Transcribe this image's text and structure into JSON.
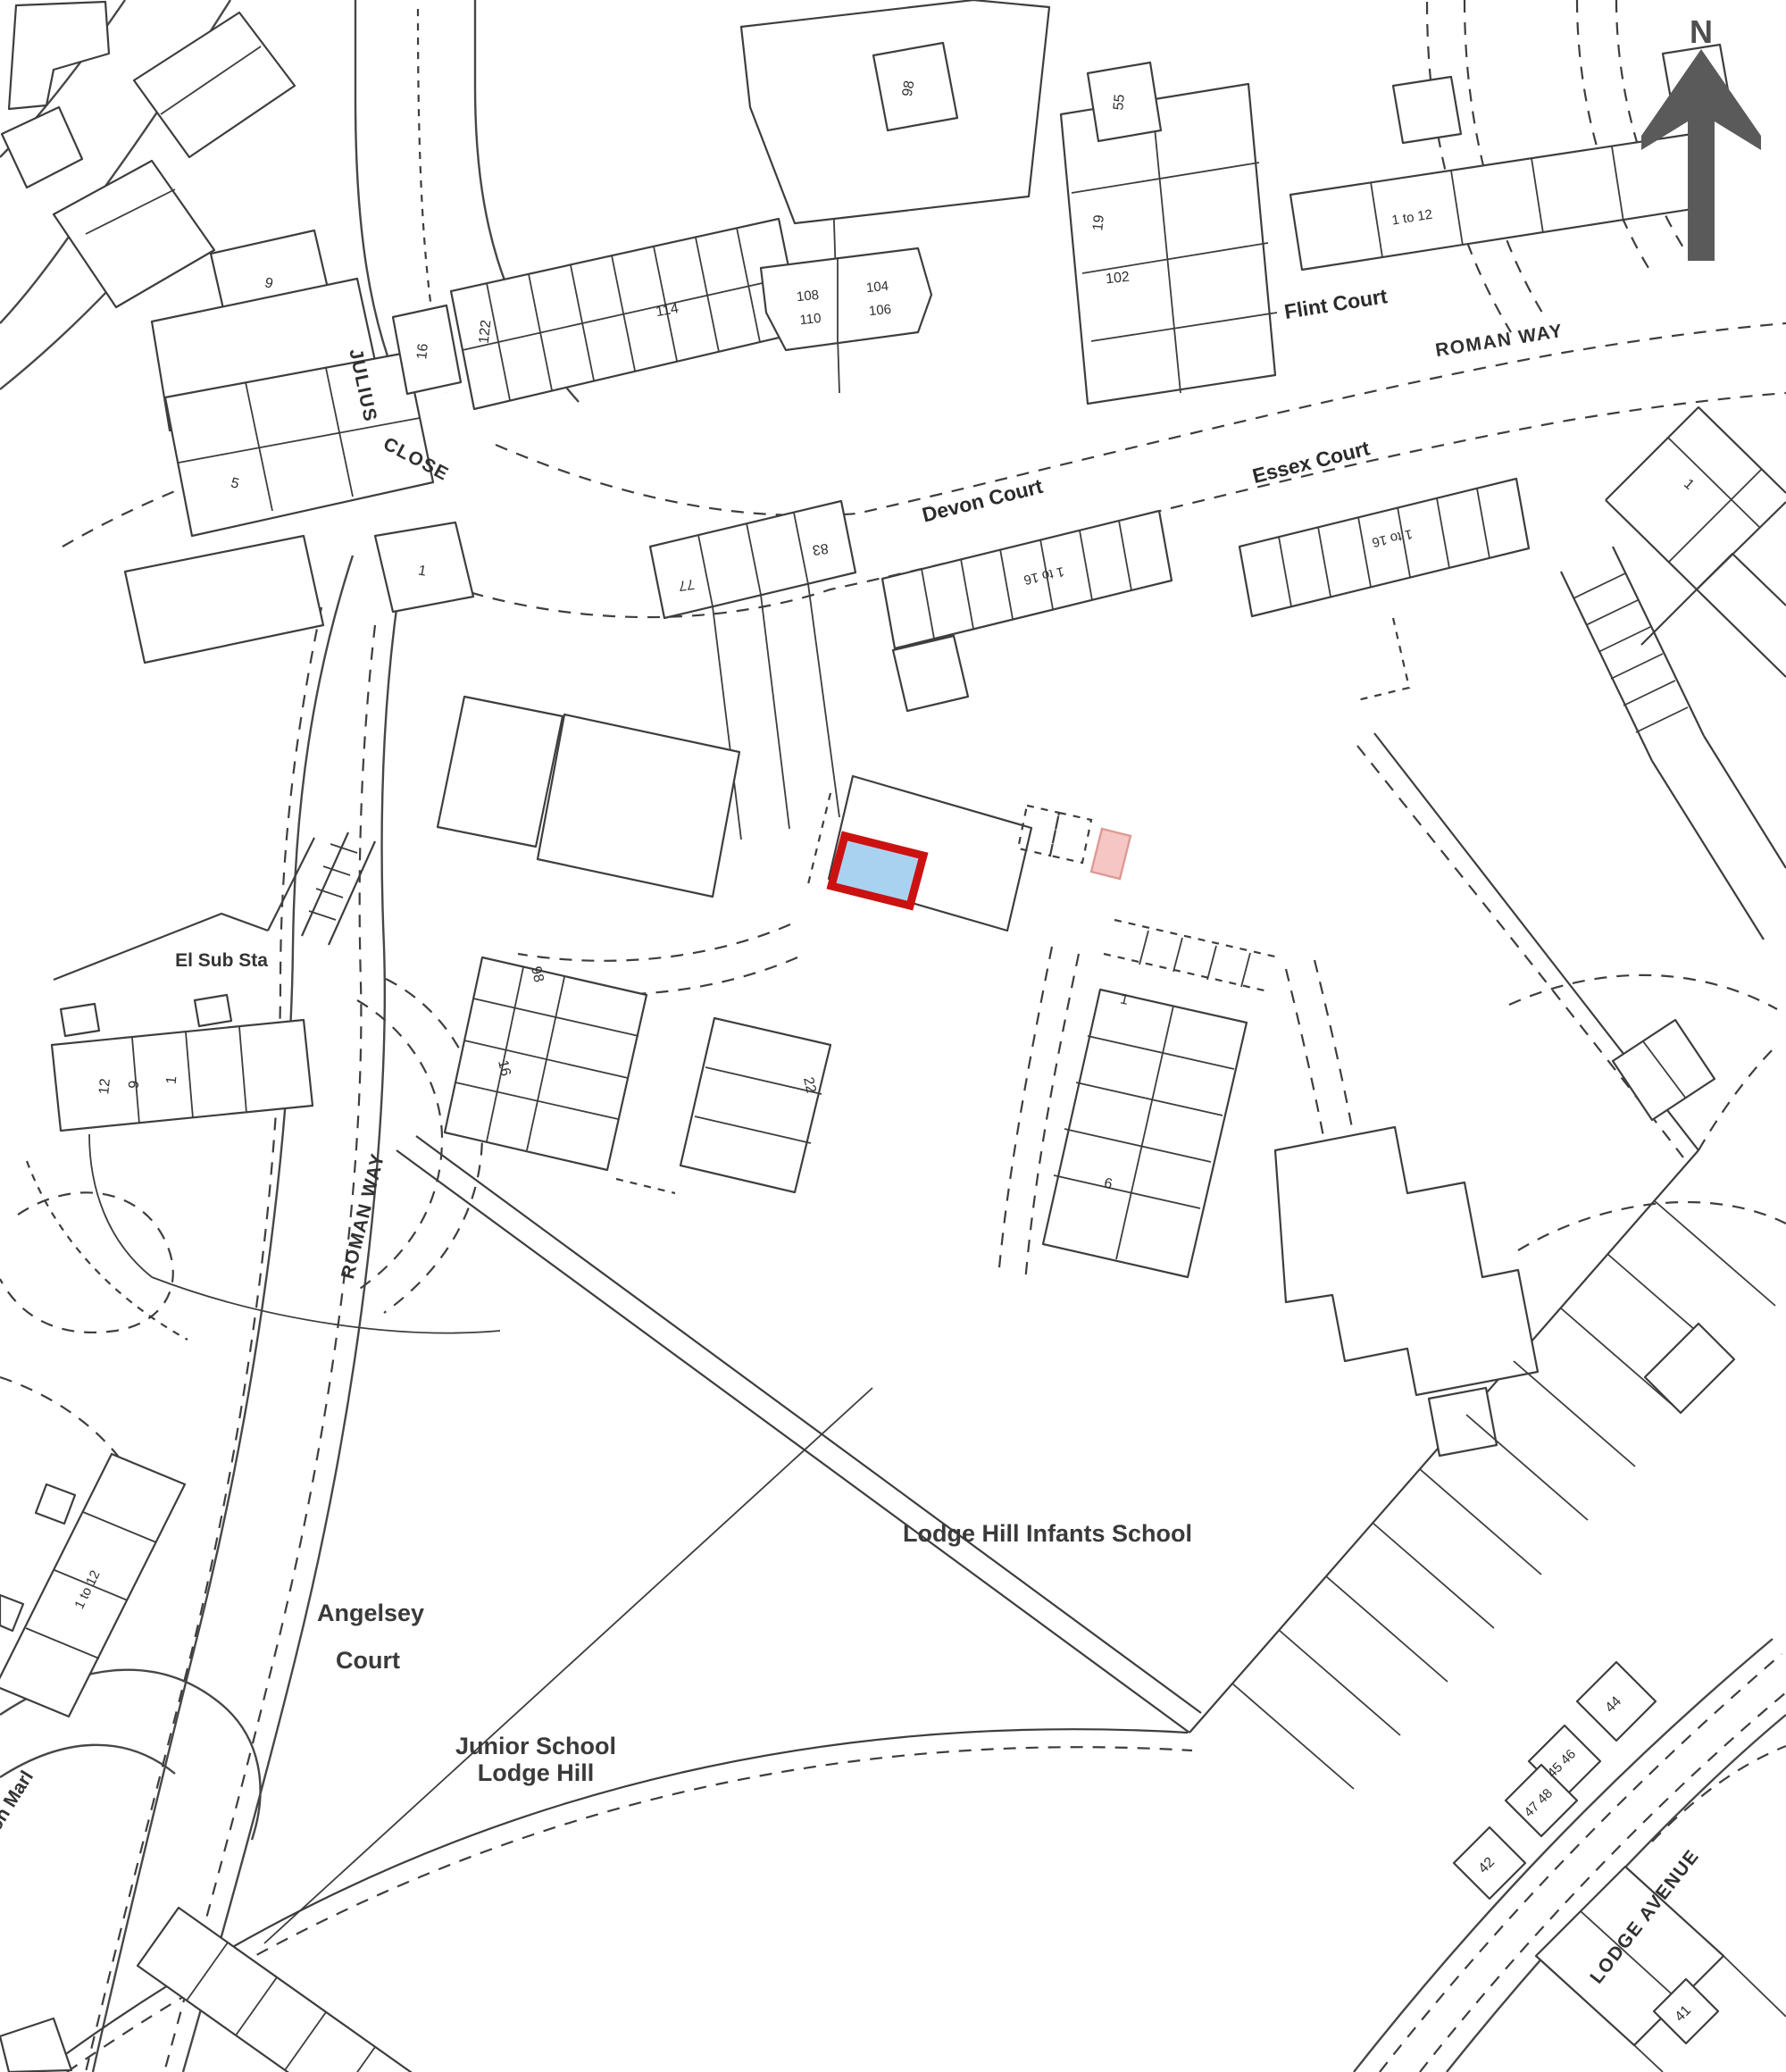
{
  "map": {
    "title": "Site location plan",
    "highlight_fill": "#a9d2f0",
    "highlight_stroke": "#cc1111",
    "secondary_fill": "#f5c6c4",
    "north_arrow_color": "#5a5a5a",
    "line_color": "#3e3e3e"
  },
  "labels": {
    "north": "N",
    "julius": "JULIUS",
    "close": "CLOSE",
    "roman_way_top": "ROMAN WAY",
    "roman_way_left": "ROMAN WAY",
    "flint_court": "Flint Court",
    "flint_range": "1 to 12",
    "devon_court": "Devon Court",
    "devon_range": "1 to 16",
    "essex_court": "Essex Court",
    "essex_range": "1 to 16",
    "el_sub_sta": "El Sub Sta",
    "lodge_hill_infants": "Lodge Hill Infants School",
    "angelsey_line1": "Angelsey",
    "angelsey_line2": "Court",
    "junior_line1": "Junior School",
    "junior_line2": "Lodge Hill",
    "angelsey_range": "1 to 12",
    "lodge_avenue": "LODGE AVENUE",
    "marl": "on Marl"
  },
  "numbers": {
    "n9": "9",
    "n5": "5",
    "n1_left": "1",
    "n16_top": "16",
    "n122": "122",
    "n114": "114",
    "n98_top": "98",
    "n108": "108",
    "n110": "110",
    "n104": "104",
    "n106": "106",
    "n55": "55",
    "n19": "19",
    "n102": "102",
    "n77": "77",
    "n83": "83",
    "n12_sub": "12",
    "n9_sub": "9",
    "n1_sub": "1",
    "n98_mid": "98",
    "n16_mid": "16",
    "n22": "22",
    "n1_mid": "1",
    "n6_mid": "6",
    "n1_right": "1",
    "n44": "44",
    "n45_46": "45 46",
    "n47_48": "47 48",
    "n42": "42",
    "n41": "41"
  }
}
